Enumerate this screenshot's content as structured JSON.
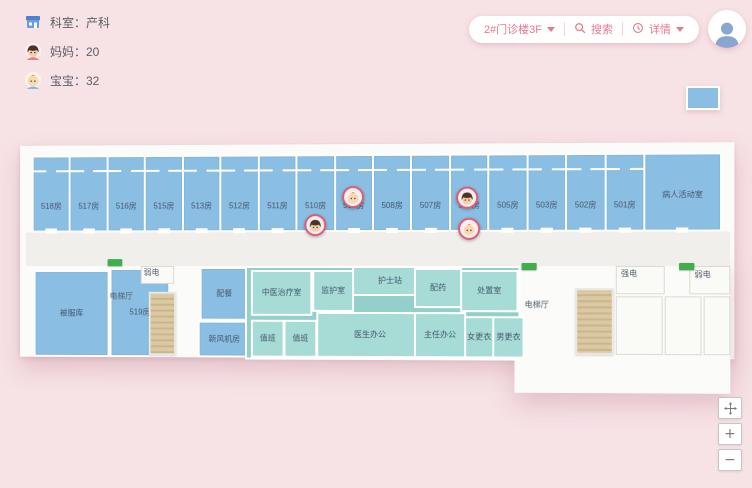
{
  "colors": {
    "background": "#f7e2e6",
    "accent_pink": "#e8798f",
    "room_blue": "#8abfe3",
    "room_teal": "#a6dcd5",
    "corridor": "#f1efeb",
    "stairs": "#dbc9a4",
    "exit_green": "#3fae4d",
    "marker_ring": "#dd5c73",
    "label_text": "#44566b"
  },
  "stats": {
    "items": [
      {
        "icon": "department-icon",
        "text": "科室：产科"
      },
      {
        "icon": "mom-icon",
        "text": "妈妈：20"
      },
      {
        "icon": "baby-icon",
        "text": "宝宝：32"
      }
    ]
  },
  "toolbar": {
    "building": "2#门诊楼3F",
    "search": "搜索",
    "details": "详情"
  },
  "controls": {
    "zoom_in": "+",
    "zoom_out": "−"
  },
  "map": {
    "ward_rooms": [
      "518房",
      "517房",
      "516房",
      "515房",
      "513房",
      "512房",
      "511房",
      "510房",
      "509房",
      "508房",
      "507房",
      "506房",
      "505房",
      "503房",
      "502房",
      "501房"
    ],
    "activity_room": "病人活动室",
    "lower_rooms": [
      {
        "label": "被服库",
        "x": 10,
        "y": 130,
        "w": 74,
        "h": 84,
        "cls": "blue"
      },
      {
        "label": "519房",
        "x": 88,
        "y": 128,
        "w": 58,
        "h": 86,
        "cls": "blue"
      },
      {
        "label": "配餐",
        "x": 180,
        "y": 127,
        "w": 46,
        "h": 50,
        "cls": "blue"
      },
      {
        "label": "新风机房",
        "x": 178,
        "y": 181,
        "w": 50,
        "h": 33,
        "cls": "blue"
      },
      {
        "label": "",
        "x": 226,
        "y": 126,
        "w": 272,
        "h": 90,
        "cls": "tealzone"
      },
      {
        "label": "中医治疗室",
        "x": 232,
        "y": 130,
        "w": 58,
        "h": 42,
        "cls": "teal"
      },
      {
        "label": "监护室",
        "x": 294,
        "y": 130,
        "w": 38,
        "h": 38,
        "cls": "teal"
      },
      {
        "label": "护士站",
        "x": 334,
        "y": 126,
        "w": 72,
        "h": 26,
        "cls": "teal"
      },
      {
        "label": "值班",
        "x": 232,
        "y": 180,
        "w": 30,
        "h": 34,
        "cls": "teal"
      },
      {
        "label": "值班",
        "x": 265,
        "y": 180,
        "w": 30,
        "h": 34,
        "cls": "teal"
      },
      {
        "label": "医生办公",
        "x": 298,
        "y": 172,
        "w": 104,
        "h": 42,
        "cls": "teal"
      },
      {
        "label": "配药",
        "x": 396,
        "y": 128,
        "w": 44,
        "h": 36,
        "cls": "teal"
      },
      {
        "label": "处置室",
        "x": 442,
        "y": 130,
        "w": 54,
        "h": 38,
        "cls": "teal"
      },
      {
        "label": "主任办公",
        "x": 396,
        "y": 172,
        "w": 48,
        "h": 42,
        "cls": "teal"
      },
      {
        "label": "女更衣",
        "x": 446,
        "y": 176,
        "w": 26,
        "h": 38,
        "cls": "teal"
      },
      {
        "label": "男更衣",
        "x": 474,
        "y": 176,
        "w": 28,
        "h": 38,
        "cls": "teal"
      },
      {
        "label": "",
        "x": 120,
        "y": 126,
        "w": 32,
        "h": 16,
        "cls": "white"
      },
      {
        "label": "",
        "x": 596,
        "y": 126,
        "w": 46,
        "h": 26,
        "cls": "white"
      },
      {
        "label": "",
        "x": 668,
        "y": 126,
        "w": 38,
        "h": 26,
        "cls": "white"
      },
      {
        "label": "",
        "x": 596,
        "y": 156,
        "w": 44,
        "h": 56,
        "cls": "white"
      },
      {
        "label": "",
        "x": 644,
        "y": 156,
        "w": 34,
        "h": 56,
        "cls": "white"
      },
      {
        "label": "",
        "x": 682,
        "y": 156,
        "w": 24,
        "h": 56,
        "cls": "white"
      }
    ],
    "area_labels": [
      {
        "text": "电梯厅",
        "x": 88,
        "y": 151
      },
      {
        "text": "弱电",
        "x": 123,
        "y": 127
      },
      {
        "text": "电梯厅",
        "x": 506,
        "y": 159
      },
      {
        "text": "强电",
        "x": 601,
        "y": 128
      },
      {
        "text": "弱电",
        "x": 673,
        "y": 129
      }
    ],
    "stairs": [
      {
        "x": 128,
        "y": 152,
        "w": 24,
        "h": 60
      },
      {
        "x": 556,
        "y": 148,
        "w": 34,
        "h": 62
      }
    ],
    "exits": [
      {
        "x": 86,
        "y": 119
      },
      {
        "x": 503,
        "y": 123
      },
      {
        "x": 658,
        "y": 123
      }
    ],
    "markers": [
      {
        "type": "baby",
        "room": "509房",
        "x": 324,
        "y": 46
      },
      {
        "type": "mom",
        "room": "510房",
        "x": 286,
        "y": 74
      },
      {
        "type": "mom",
        "room": "506房",
        "x": 438,
        "y": 47
      },
      {
        "type": "baby",
        "room": "506房",
        "x": 440,
        "y": 78
      }
    ]
  }
}
